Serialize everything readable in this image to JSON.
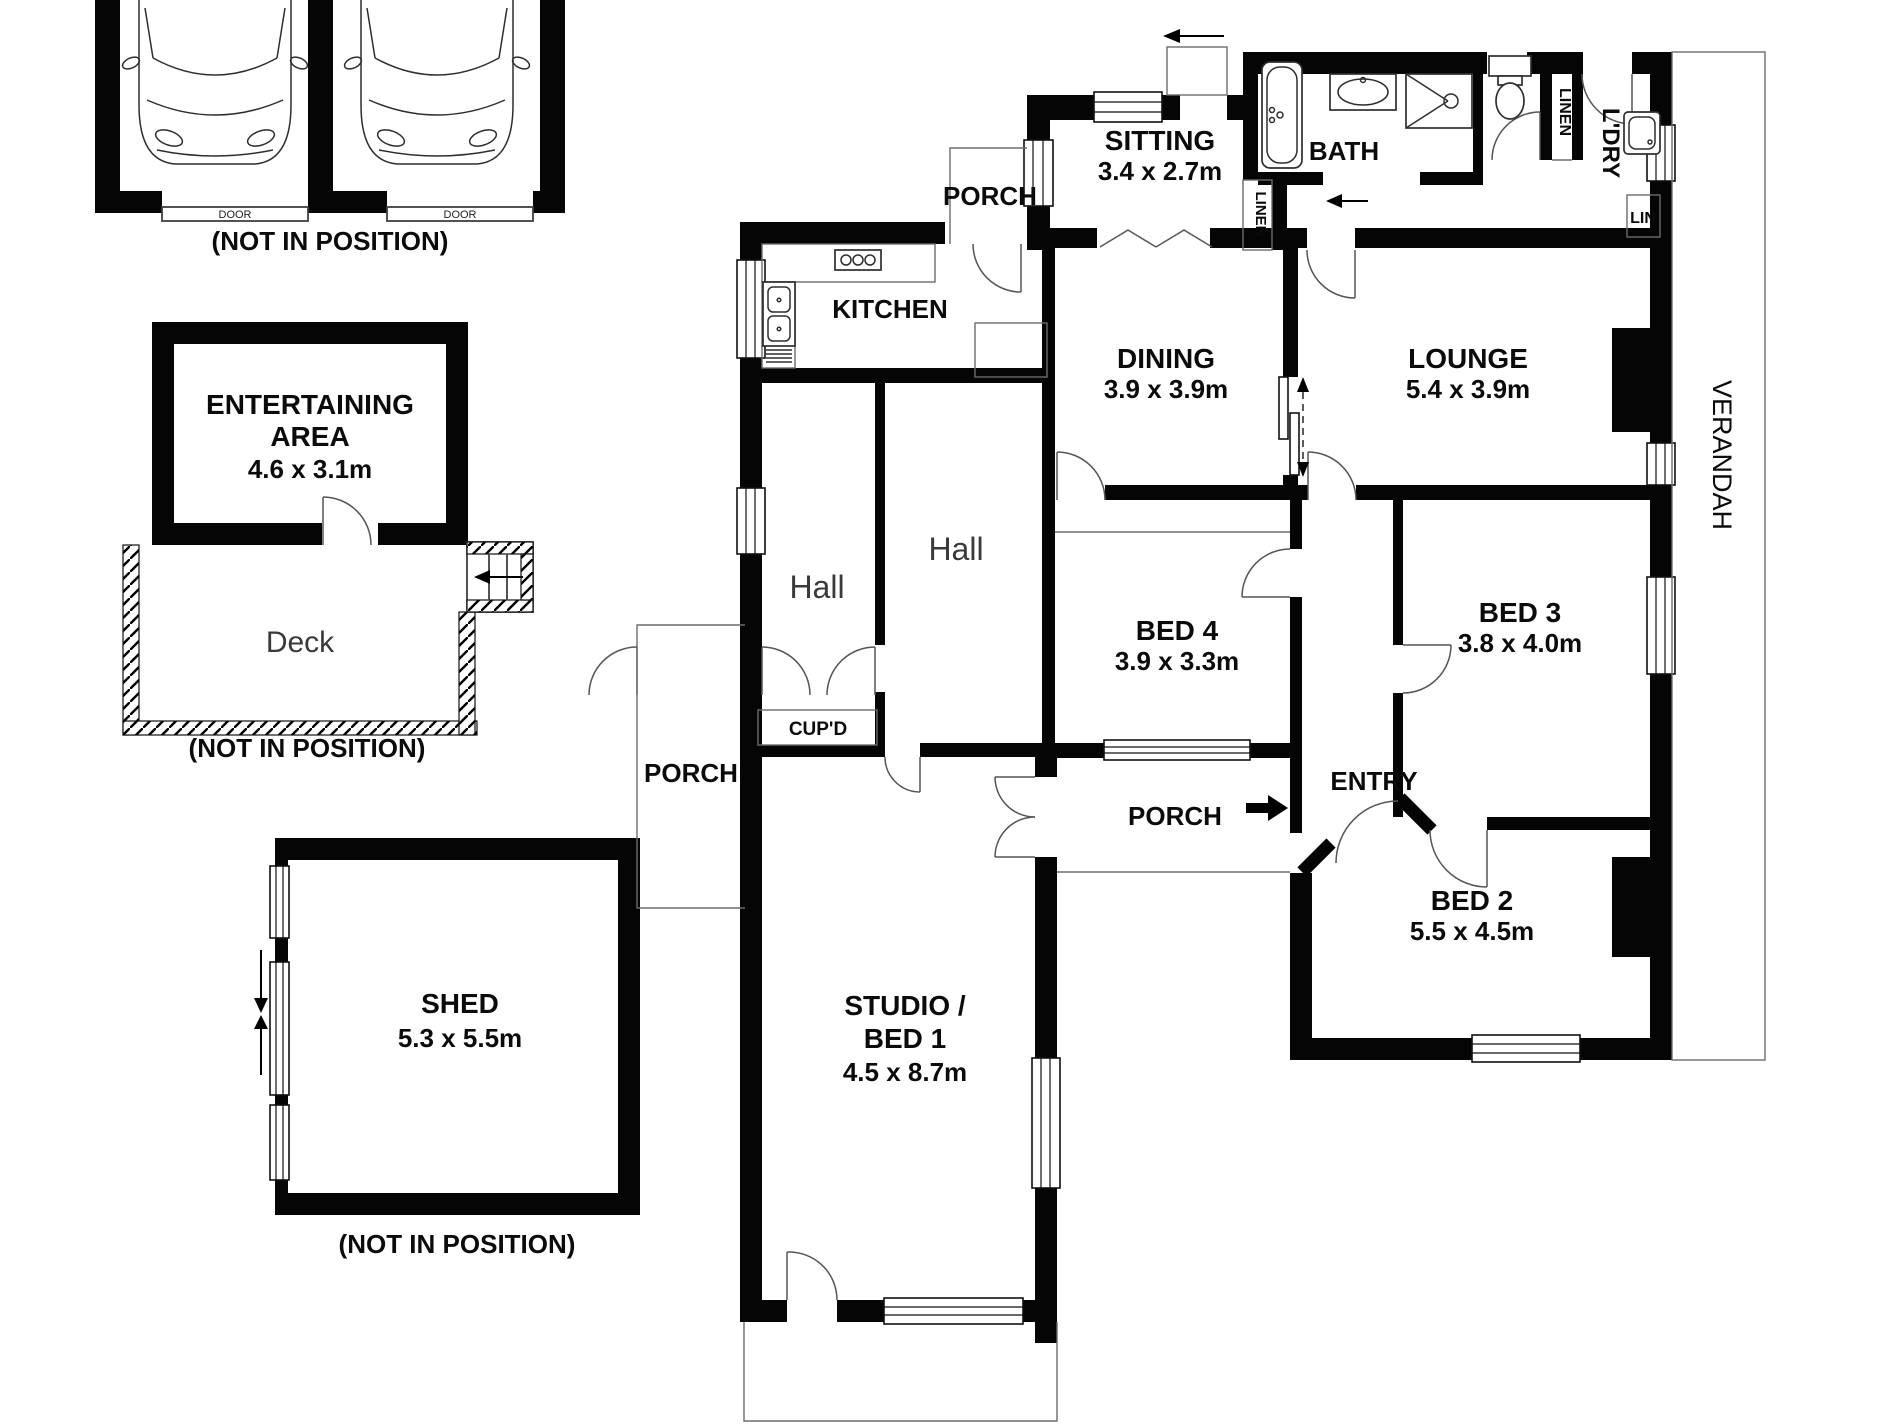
{
  "labels": {
    "garage_door_left": "DOOR",
    "garage_door_right": "DOOR",
    "garage_note": "(NOT IN POSITION)",
    "entertaining_line1": "ENTERTAINING",
    "entertaining_line2": "AREA",
    "entertaining_dims": "4.6 x 3.1m",
    "deck": "Deck",
    "deck_note": "(NOT IN POSITION)",
    "shed": "SHED",
    "shed_dims": "5.3 x 5.5m",
    "shed_note": "(NOT IN POSITION)",
    "porch_top": "PORCH",
    "sitting": "SITTING",
    "sitting_dims": "3.4 x 2.7m",
    "bath": "BATH",
    "linen_bath": "LINEN",
    "linen_hall": "LINEN",
    "laundry": "L'DRY",
    "lin": "LIN",
    "kitchen": "KITCHEN",
    "dining": "DINING",
    "dining_dims": "3.9 x 3.9m",
    "lounge": "LOUNGE",
    "lounge_dims": "5.4 x 3.9m",
    "hall_left": "Hall",
    "hall_center": "Hall",
    "bed4": "BED 4",
    "bed4_dims": "3.9 x 3.3m",
    "bed3": "BED 3",
    "bed3_dims": "3.8 x 4.0m",
    "cupd": "CUP'D",
    "porch_left": "PORCH",
    "porch_entry": "PORCH",
    "entry": "ENTRY",
    "bed2": "BED 2",
    "bed2_dims": "5.5 x 4.5m",
    "studio_line1": "STUDIO /",
    "studio_line2": "BED 1",
    "studio_dims": "4.5 x 8.7m",
    "verandah": "VERANDAH"
  },
  "colors": {
    "wall": "#050505",
    "background": "#ffffff",
    "line": "#3f3f3f"
  }
}
